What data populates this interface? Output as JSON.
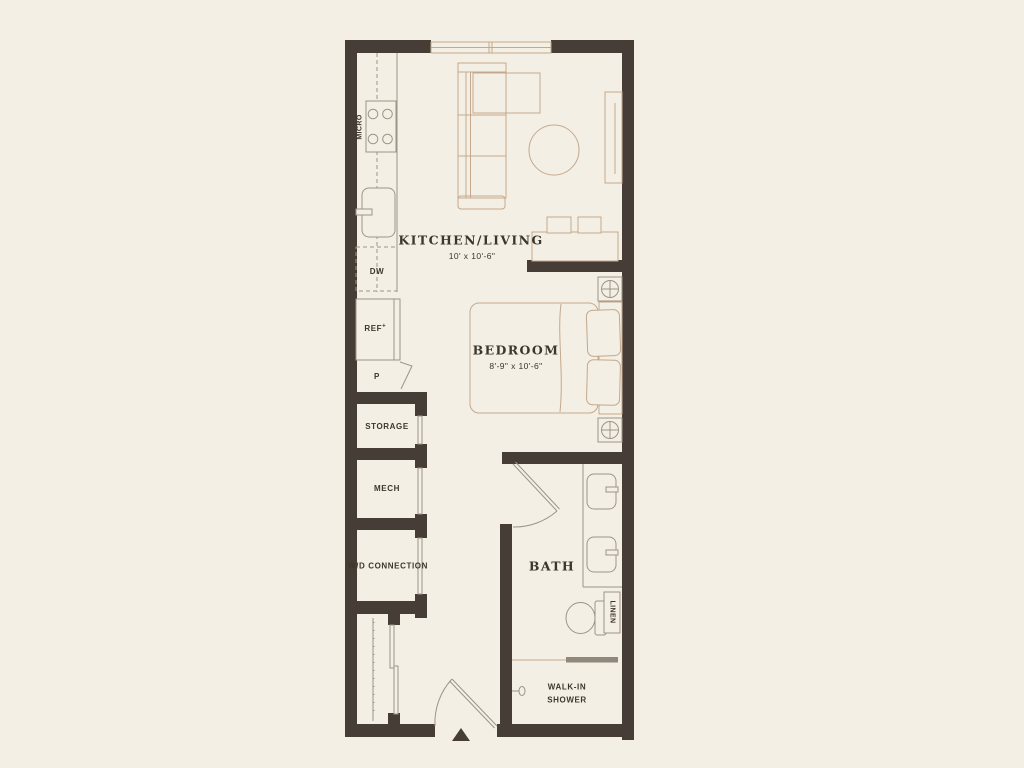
{
  "plan": {
    "rooms": {
      "kitchen_living": {
        "title": "KITCHEN/LIVING",
        "dims": "10' x 10'-6\""
      },
      "bedroom": {
        "title": "BEDROOM",
        "dims": "8'-9\" x 10'-6\""
      },
      "bath": {
        "title": "BATH"
      },
      "storage": {
        "label": "STORAGE"
      },
      "mech": {
        "label": "MECH"
      },
      "wd": {
        "label": "W/D CONNECTION"
      },
      "shower": {
        "label": "WALK-IN SHOWER"
      }
    },
    "fixtures": {
      "micro": "MICRO",
      "dw": "DW",
      "ref": "REF",
      "ref_mark": "+",
      "pantry": "P",
      "linen": "LINEN"
    },
    "colors": {
      "background": "#f4efe4",
      "wall": "#463e36",
      "furniture": "#c3a88d",
      "fixture": "#9b9588",
      "text": "#3b352b"
    }
  }
}
